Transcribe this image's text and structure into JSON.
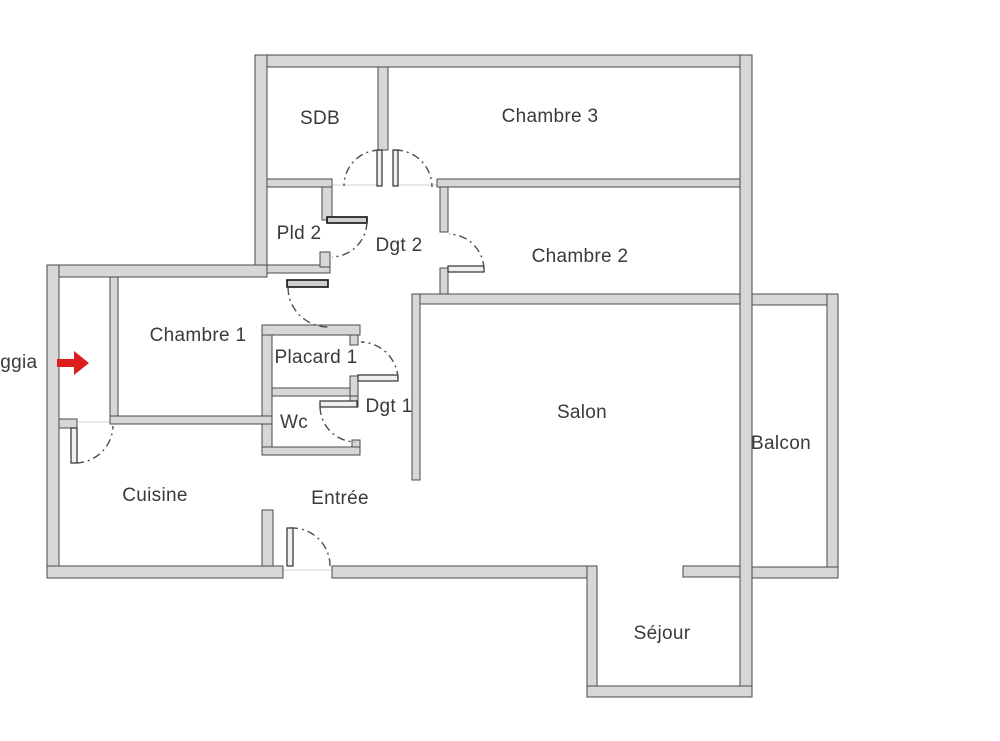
{
  "title": "Plan d'appartement",
  "colors": {
    "wall_fill": "#d7d7d7",
    "wall_stroke": "#4a4a4a",
    "arrow_red": "#dd1e1e",
    "label_text": "#3a3a3a"
  },
  "rooms": {
    "sdb": {
      "label": "SDB"
    },
    "chambre3": {
      "label": "Chambre 3"
    },
    "pld2": {
      "label": "Pld 2"
    },
    "dgt2": {
      "label": "Dgt 2"
    },
    "chambre2": {
      "label": "Chambre 2"
    },
    "chambre1": {
      "label": "Chambre 1"
    },
    "placard1": {
      "label": "Placard 1"
    },
    "loggia": {
      "label": "Loggia"
    },
    "wc": {
      "label": "Wc"
    },
    "dgt1": {
      "label": "Dgt 1"
    },
    "salon": {
      "label": "Salon"
    },
    "balcon": {
      "label": "Balcon"
    },
    "cuisine": {
      "label": "Cuisine"
    },
    "entree": {
      "label": "Entrée"
    },
    "sejour": {
      "label": "Séjour"
    }
  }
}
